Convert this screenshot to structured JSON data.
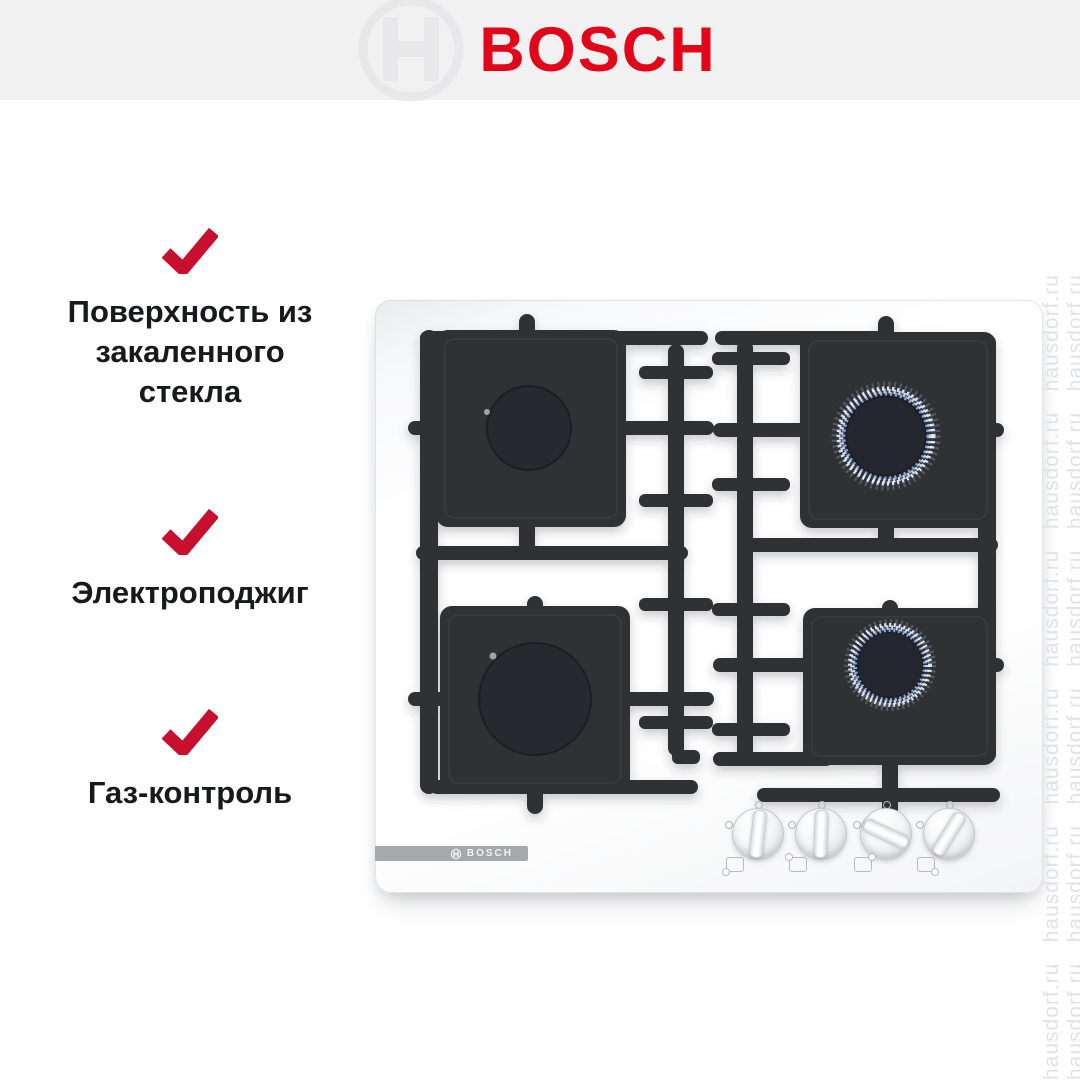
{
  "header": {
    "brand": "BOSCH",
    "brand_color": "#e2061a",
    "background_color": "#f1f1f2"
  },
  "features": {
    "check_color": "#c8102e",
    "items": [
      {
        "lines": [
          "Поверхность из",
          "закаленного",
          "стекла"
        ]
      },
      {
        "lines": [
          "Электроподжиг"
        ]
      },
      {
        "lines": [
          "Газ-контроль"
        ]
      }
    ]
  },
  "hob": {
    "badge_text": "BOSCH",
    "surface_color": "#ffffff",
    "grate_color": "#2e3136",
    "flame_color": "#c7d4f2",
    "burners": [
      {
        "position": "back-left",
        "state": "off"
      },
      {
        "position": "front-left",
        "state": "off"
      },
      {
        "position": "back-right",
        "state": "lit"
      },
      {
        "position": "front-right",
        "state": "lit"
      }
    ],
    "knobs": [
      {
        "angle": 6
      },
      {
        "angle": 2
      },
      {
        "angle": 115
      },
      {
        "angle": 32
      }
    ]
  },
  "watermark": {
    "text": "hausdorf.ru",
    "color": "#e1e2e6",
    "column_text": "hausdorf.ru   hausdorf.ru   hausdorf.ru   hausdorf.ru   hausdorf.ru   hausdorf.ru"
  }
}
